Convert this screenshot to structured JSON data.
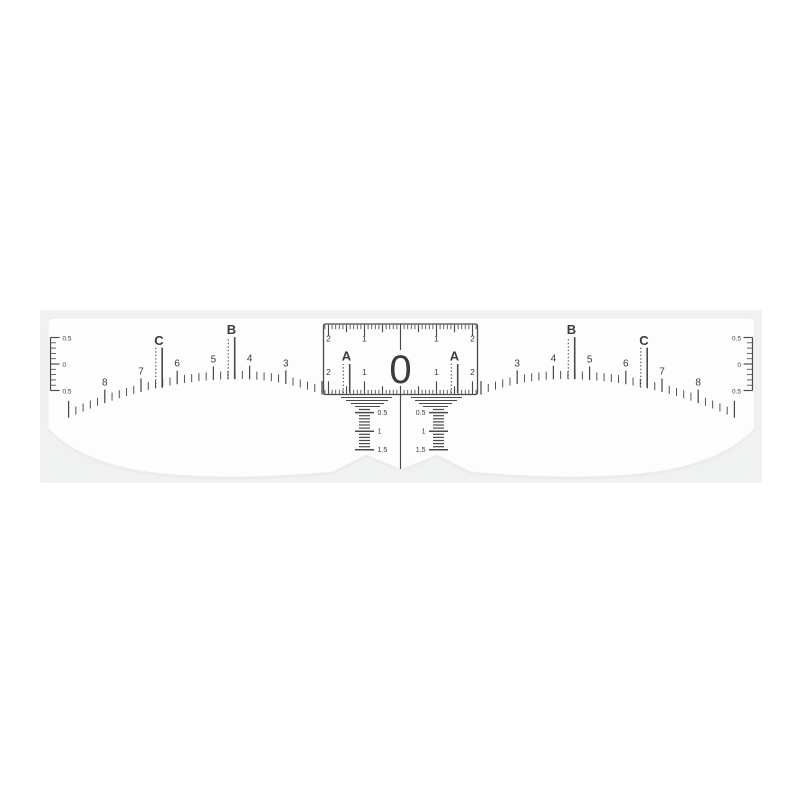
{
  "colors": {
    "page_bg": "#ffffff",
    "panel_bg": "#f0f1f1",
    "sticker_fill": "#fdfdfd",
    "sticker_shadow": "#e9eaeb",
    "ink": "#4a4a4a"
  },
  "ruler": {
    "center_zero": "0",
    "letters": {
      "a": "A",
      "b": "B",
      "c": "C"
    },
    "arc_numbers_left": [
      "8",
      "7",
      "6",
      "5",
      "4",
      "3"
    ],
    "arc_numbers_right": [
      "3",
      "4",
      "5",
      "6",
      "7",
      "8"
    ],
    "box_scale": {
      "top_left": [
        "2",
        "1"
      ],
      "top_right": [
        "1",
        "2"
      ],
      "inner_left": [
        "2",
        "1"
      ],
      "inner_right": [
        "1",
        "2"
      ]
    },
    "drop_scale": [
      "0.5",
      "1",
      "1.5"
    ],
    "end_scale": [
      "0.5",
      "0",
      "0.5"
    ]
  }
}
